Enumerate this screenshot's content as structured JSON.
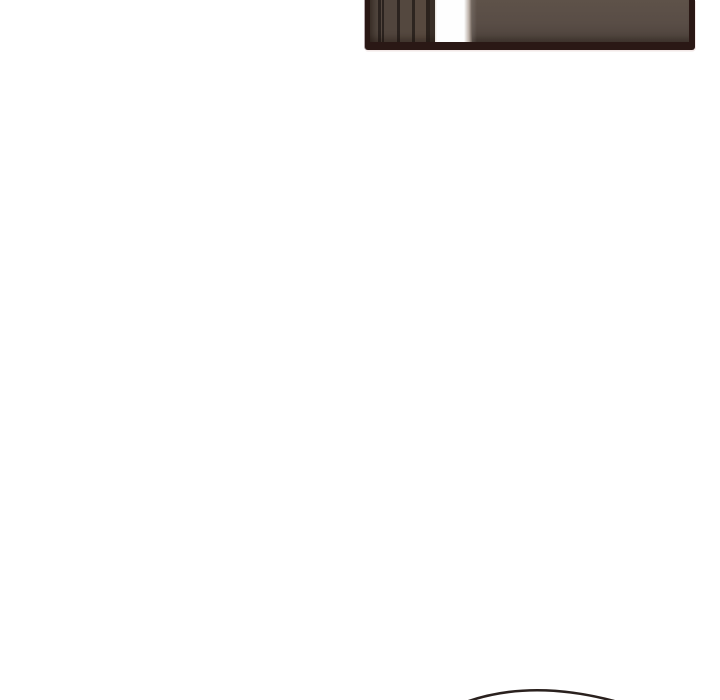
{
  "page": {
    "background": "#ffffff",
    "width_px": 720,
    "height_px": 700
  },
  "colors": {
    "page-bg": "#ffffff",
    "panel-border": "#2a1815",
    "panel-wall": "#594d46",
    "panel-wall-dark": "#4a3f38",
    "panel-seam": "#2b231f",
    "doorway": "#fefefe",
    "panel-halo": "#f3e9e8",
    "panel-halo-left": "#b3a7ab",
    "arc-stroke": "#2a211e"
  },
  "artwork": {
    "top_panel_description": "Bottom sliver of a comic panel: dark maroon frame around a brown interior wall with vertical paneling seams and a bright white doorway gap of light",
    "bottom_arc_description": "Thin dark hand-drawn arc (top of a head outline) entering from the bottom edge of the page"
  }
}
